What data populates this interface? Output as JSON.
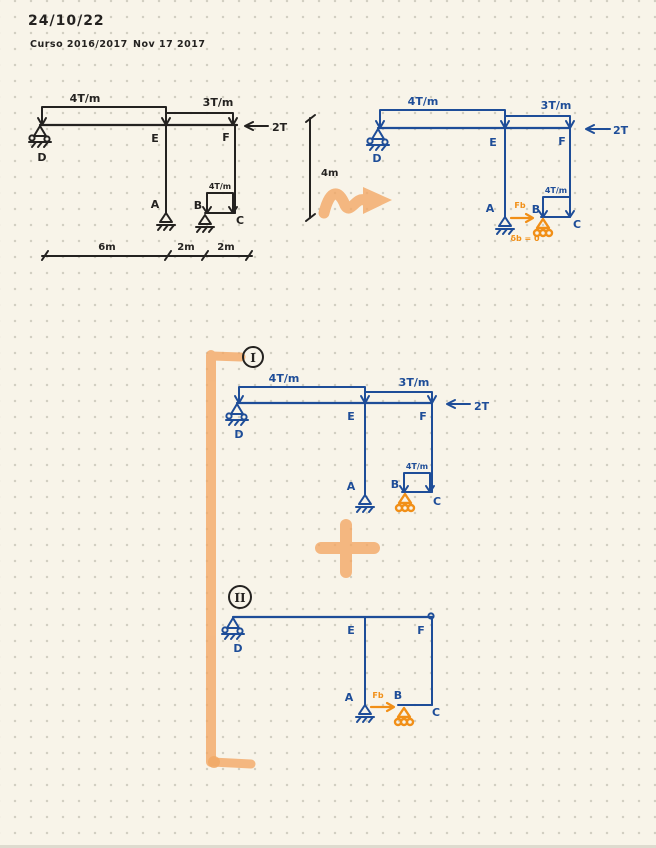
{
  "header": {
    "date": "24/10/22",
    "course": "Curso 2016/2017",
    "note": "Nov 17 2017"
  },
  "colors": {
    "paper": "#f8f4e9",
    "dots": "#d2cfc2",
    "ink_black": "#242220",
    "ink_blue": "#1e4d98",
    "ink_orange": "#f18f17",
    "highlighter": "#f4a763"
  },
  "original": {
    "load_de": "4T/m",
    "load_ef": "3T/m",
    "load_bc": "4T/m",
    "force_f": "2T",
    "nodes": {
      "d": "D",
      "e": "E",
      "f": "F",
      "a": "A",
      "b": "B",
      "c": "C"
    },
    "dims": {
      "de": "6m",
      "eb": "2m",
      "bc": "2m",
      "height": "4m"
    }
  },
  "released": {
    "load_de": "4T/m",
    "load_ef": "3T/m",
    "load_bc": "4T/m",
    "force_f": "2T",
    "nodes": {
      "d": "D",
      "e": "E",
      "f": "F",
      "a": "A",
      "b": "B",
      "c": "C"
    },
    "redundant": "Fb",
    "compat": "δb = 0"
  },
  "case1": {
    "numeral": "I",
    "load_de": "4T/m",
    "load_ef": "3T/m",
    "load_bc": "4T/m",
    "force_f": "2T",
    "nodes": {
      "d": "D",
      "e": "E",
      "f": "F",
      "a": "A",
      "b": "B",
      "c": "C"
    }
  },
  "case2": {
    "numeral": "II",
    "nodes": {
      "d": "D",
      "e": "E",
      "f": "F",
      "a": "A",
      "b": "B",
      "c": "C"
    },
    "redundant": "Fb"
  }
}
